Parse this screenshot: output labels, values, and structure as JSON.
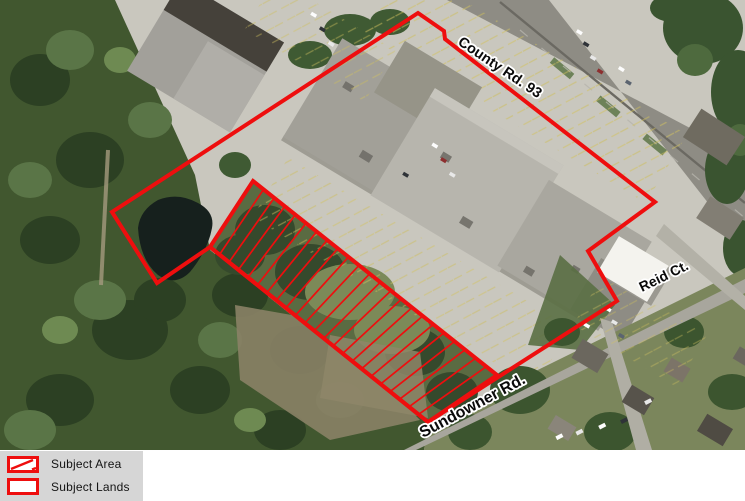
{
  "map": {
    "labels": {
      "county_road": "County Rd. 93",
      "reid_court": "Reid Ct.",
      "sundowner_road": "Sundowner Rd."
    },
    "annotations": {
      "red": "#ee0e0e",
      "subject_lands_points": "418,13 444,31 445,39 655,202 588,251 617,301 428,422 210,247 157,283 112,212",
      "subject_area_points": "253,181 497,375 428,422 210,247",
      "subject_area_corners": {
        "a": [
          253,
          181
        ],
        "d": [
          497,
          375
        ],
        "c": [
          428,
          422
        ],
        "b": [
          210,
          247
        ]
      },
      "hatch_line_count": 22
    }
  },
  "legend": {
    "background": "#d6d6d6",
    "items": [
      {
        "label": "Subject Area",
        "swatch": "hatched-rectangle"
      },
      {
        "label": "Subject Lands",
        "swatch": "outline-rectangle"
      }
    ]
  }
}
